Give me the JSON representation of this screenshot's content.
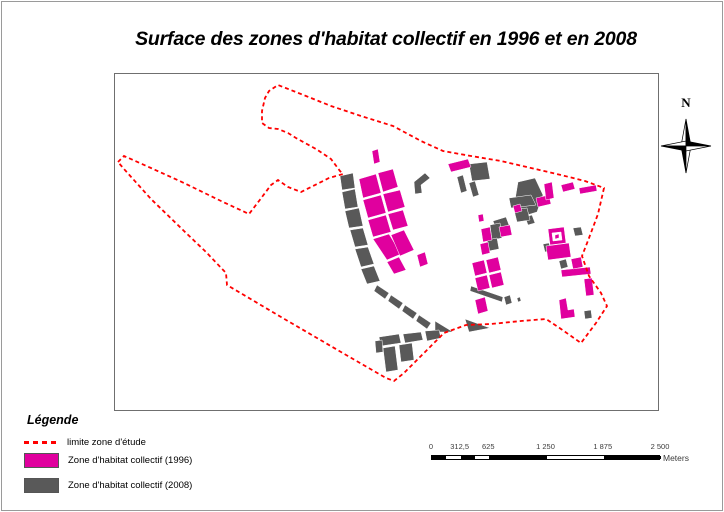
{
  "title": "Surface des zones d'habitat collectif en 1996 et en 2008",
  "colors": {
    "zone_1996": "#E0009E",
    "zone_2008": "#595959",
    "boundary": "#FF0000",
    "frame": "#6F6F6F"
  },
  "north_arrow": {
    "label": "N"
  },
  "legend": {
    "heading": "Légende",
    "items": [
      {
        "label": "limite zone d'étude",
        "type": "dashed-line",
        "color": "#FF0000"
      },
      {
        "label": "Zone d'habitat collectif (1996)",
        "type": "fill",
        "color": "#E0009E"
      },
      {
        "label": "Zone d'habitat collectif (2008)",
        "type": "fill",
        "color": "#595959"
      }
    ]
  },
  "scale_bar": {
    "max_m": 2500,
    "ticks": [
      {
        "label": "0",
        "value": 0
      },
      {
        "label": "312,5",
        "value": 312.5
      },
      {
        "label": "625",
        "value": 625
      },
      {
        "label": "1 250",
        "value": 1250
      },
      {
        "label": "1 875",
        "value": 1875
      },
      {
        "label": "2 500",
        "value": 2500
      }
    ],
    "segments_m": [
      [
        0,
        156.25,
        "#000000"
      ],
      [
        156.25,
        312.5,
        "#ffffff"
      ],
      [
        312.5,
        468.75,
        "#000000"
      ],
      [
        468.75,
        625,
        "#ffffff"
      ],
      [
        625,
        1250,
        "#000000"
      ],
      [
        1250,
        1875,
        "#ffffff"
      ],
      [
        1875,
        2500,
        "#000000"
      ]
    ],
    "unit_label": "Meters"
  },
  "map": {
    "boundary_points": "117,161 123,155 150,167 183,182 220,200 248,213 258,200 270,184 277,179 287,186 300,191 312,185 328,177 342,173 339,170 330,158 315,148 295,137 287,132 277,128 268,127 261,122 261,110 264,97 268,90 277,84 305,95 330,105 360,115 392,125 420,140 442,150 470,155 500,160 530,167 560,174 584,180 603,187 600,200 597,213 588,237 581,255 588,275 600,292 606,305 595,322 580,342 560,328 545,318 520,320 490,323 465,324 443,332 420,355 403,372 393,380 385,377 340,351 280,316 226,284 225,272 205,251 183,230 150,198 123,168",
    "layers": [
      {
        "name": "zones-2008",
        "color": "#595959",
        "polygons": [
          "339,175 352,172 354,187 341,189",
          "341,191 354,188 357,206 344,208",
          "344,210 358,207 362,225 348,227",
          "349,229 362,227 367,244 354,246",
          "354,248 367,246 373,263 360,266",
          "360,268 373,265 379,280 366,283",
          "376,284 388,292 384,298 373,290",
          "390,294 402,302 398,308 387,300",
          "404,304 416,312 412,318 401,310",
          "418,314 430,322 426,328 415,320",
          "434,320 452,331 434,331",
          "464,318 489,327 468,331",
          "413,181 424,172 429,177 420,184 421,192 414,193",
          "468,163 486,161 489,178 471,180",
          "456,176 462,174 466,190 460,192",
          "468,182 474,180 478,194 472,196",
          "517,181 534,177 542,194 536,211 523,215 514,199",
          "524,216 531,214 534,222 527,224",
          "508,197 530,194 535,204 510,207",
          "513,209 526,207 529,219 516,221",
          "572,227 580,226 582,234 574,235",
          "542,243 548,242 550,250 544,251",
          "558,260 565,258 567,266 560,268",
          "492,220 505,216 508,224 495,228",
          "489,224 499,222 501,237 491,239",
          "486,239 496,237 498,248 488,250",
          "470,285 502,296 501,301 469,290",
          "503,296 509,294 511,302 505,304",
          "516,297 519,296 520,300 517,301",
          "583,310 590,309 591,317 584,318",
          "378,336 398,333 400,342 380,345",
          "402,333 420,331 422,339 404,342",
          "424,330 438,329 440,337 426,340",
          "374,340 381,339 382,351 375,352",
          "382,347 394,345 397,369 385,371",
          "398,344 411,342 413,359 400,361"
        ]
      },
      {
        "name": "zones-1996",
        "color": "#E0009E",
        "polygons": [
          "371,150 377,148 379,161 373,163",
          "358,178 375,173 380,192 362,197",
          "377,172 392,168 397,186 382,191",
          "362,199 380,194 385,212 367,217",
          "382,193 399,189 404,206 387,211",
          "367,219 385,214 390,231 372,236",
          "387,213 402,209 407,225 392,229",
          "372,238 388,233 400,253 386,259",
          "390,234 403,229 413,249 399,255",
          "386,261 398,256 405,269 393,273",
          "416,254 424,251 427,263 419,266",
          "447,163 467,158 470,166 450,171",
          "477,214 482,213 483,220 478,221",
          "560,184 572,181 574,188 562,191",
          "578,187 595,184 596,190 579,193",
          "535,197 548,194 550,203 537,206",
          "512,205 519,203 521,210 514,212",
          "543,183 551,181 553,197 545,199",
          "480,228 489,226 491,239 482,241",
          "498,226 509,224 511,234 500,236",
          "479,243 487,241 489,252 481,254",
          "471,262 483,259 486,272 474,275",
          "485,259 497,256 500,269 488,272",
          "474,277 486,274 489,287 477,290",
          "488,274 500,271 503,284 491,287",
          "474,299 484,296 487,310 477,313",
          "547,228 563,226 565,242 549,244",
          "545,245 568,242 570,256 547,259",
          "560,269 589,266 590,273 561,276",
          "583,278 591,277 593,294 585,295",
          "570,258 580,256 582,266 572,268",
          "558,299 565,297 567,309 573,308 574,316 560,318"
        ]
      },
      {
        "name": "courtyard-white",
        "color": "#FFFFFF",
        "polygons": [
          "551,232 560,231 561,239 552,240"
        ]
      },
      {
        "name": "courtyard-dot-1996",
        "color": "#E0009E",
        "polygons": [
          "554,234 558,233 558,237 554,238"
        ]
      }
    ]
  }
}
